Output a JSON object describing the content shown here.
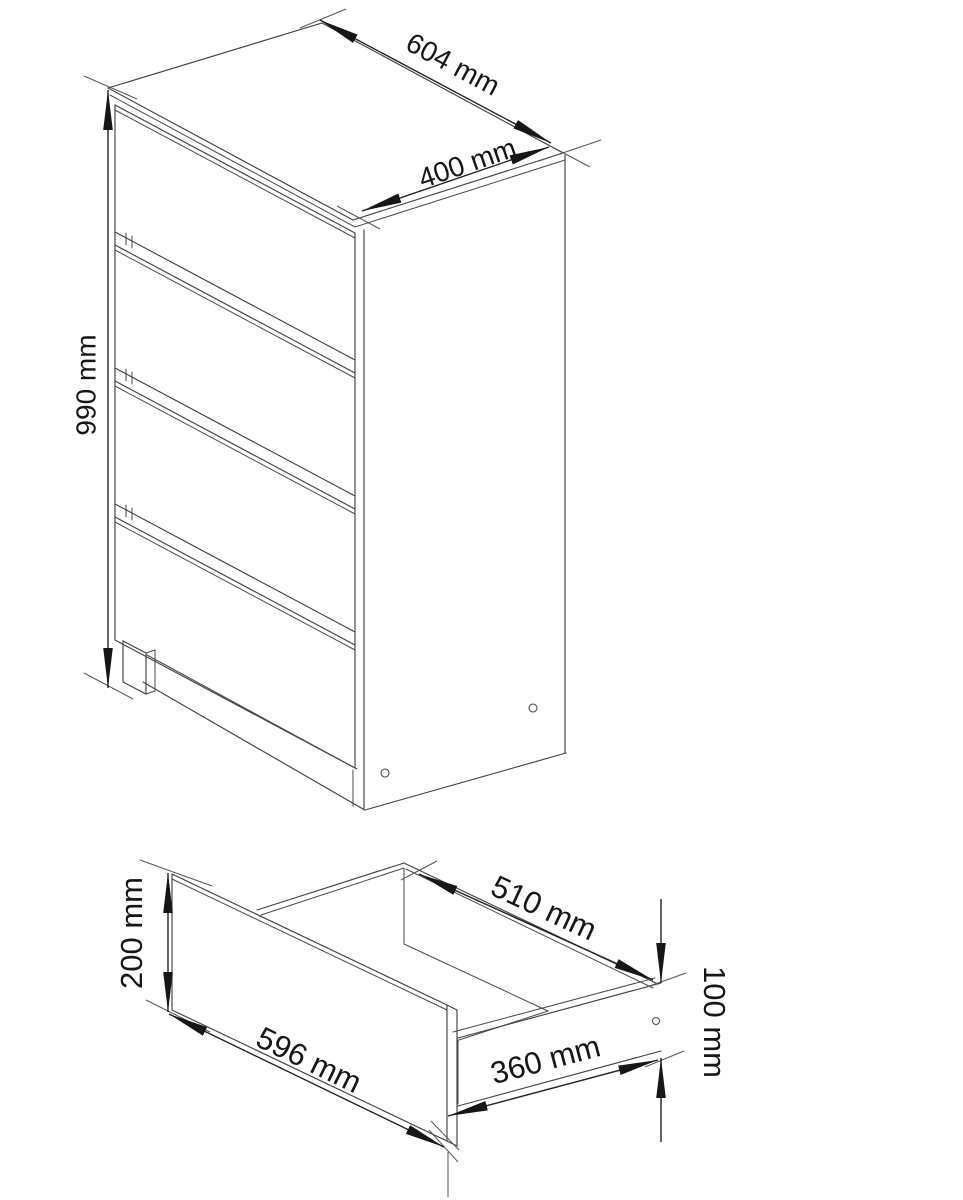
{
  "page": {
    "background": "#ffffff"
  },
  "drawing": {
    "type": "furniture-dimension-diagram",
    "views": {
      "cabinet": {
        "description": "four-drawer chest, isometric view",
        "drawer_count": 4,
        "dimensions": {
          "width": "604 mm",
          "depth": "400 mm",
          "height": "990 mm"
        }
      },
      "drawer": {
        "description": "single drawer box, isometric view",
        "dimensions": {
          "front_width": "596 mm",
          "front_height": "200 mm",
          "inner_width": "510 mm",
          "box_depth": "360 mm",
          "side_height": "100 mm"
        }
      }
    },
    "colors": {
      "line": "#434343",
      "dimension_line": "#222222",
      "text": "#161616",
      "background": "#ffffff"
    }
  }
}
